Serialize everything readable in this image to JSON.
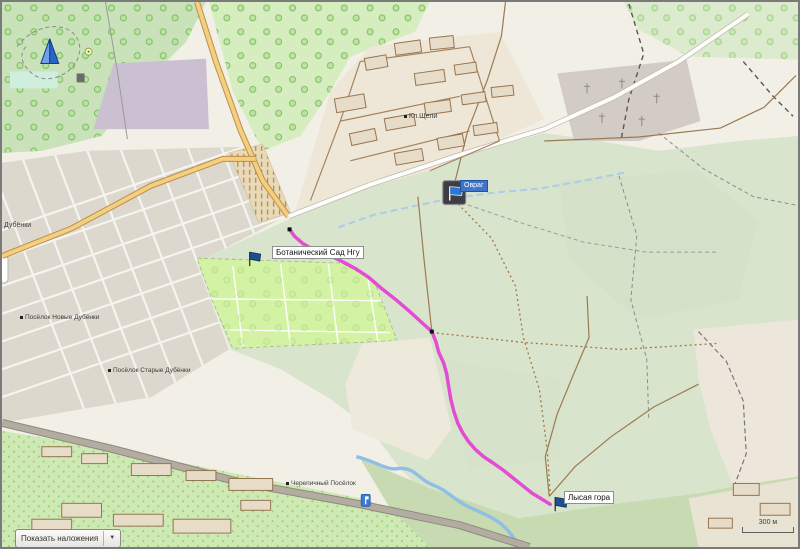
{
  "controls": {
    "overlay_button": {
      "label": "Показать наложения",
      "dropdown_glyph": "▼"
    },
    "scale_bar": {
      "label": "300 м"
    }
  },
  "waypoints": [
    {
      "name": "Ботанический Сад Нгу",
      "marker": "blue-flag"
    },
    {
      "name": "Овраг",
      "marker": "selected-flag-icon",
      "selected": true
    },
    {
      "name": "Лысая гора",
      "marker": "blue-flag"
    }
  ],
  "map_labels": {
    "dubenki": "Дубёнки",
    "novye_dubenki": "Посёлок Новые Дубёнки",
    "starye_dubenki": "Посёлок Старые Дубёнки",
    "kl_shcheli": "Кл.Щели",
    "cherepichny": "Черепичный Посёлок"
  },
  "track": {
    "color": "#e33bd4",
    "points": [
      [
        289,
        229
      ],
      [
        294,
        236
      ],
      [
        302,
        243
      ],
      [
        312,
        249
      ],
      [
        322,
        253
      ],
      [
        333,
        257
      ],
      [
        343,
        262
      ],
      [
        356,
        269
      ],
      [
        368,
        277
      ],
      [
        382,
        289
      ],
      [
        396,
        300
      ],
      [
        410,
        312
      ],
      [
        422,
        323
      ],
      [
        432,
        332
      ],
      [
        436,
        342
      ],
      [
        439,
        353
      ],
      [
        444,
        364
      ],
      [
        447,
        375
      ],
      [
        449,
        388
      ],
      [
        451,
        400
      ],
      [
        454,
        412
      ],
      [
        458,
        424
      ],
      [
        463,
        434
      ],
      [
        469,
        443
      ],
      [
        476,
        451
      ],
      [
        484,
        458
      ],
      [
        493,
        464
      ],
      [
        503,
        471
      ],
      [
        513,
        479
      ],
      [
        523,
        487
      ],
      [
        533,
        495
      ],
      [
        543,
        501
      ],
      [
        551,
        506
      ]
    ],
    "point_markers": [
      [
        289,
        229
      ],
      [
        312,
        257
      ],
      [
        432,
        332
      ]
    ]
  },
  "colors": {
    "route": "#e33bd4",
    "water": "#9ec9e8",
    "selected_label_bg": "#3f74c9",
    "flag": "#1f4f8f",
    "position_marker": "#2b64c8"
  }
}
